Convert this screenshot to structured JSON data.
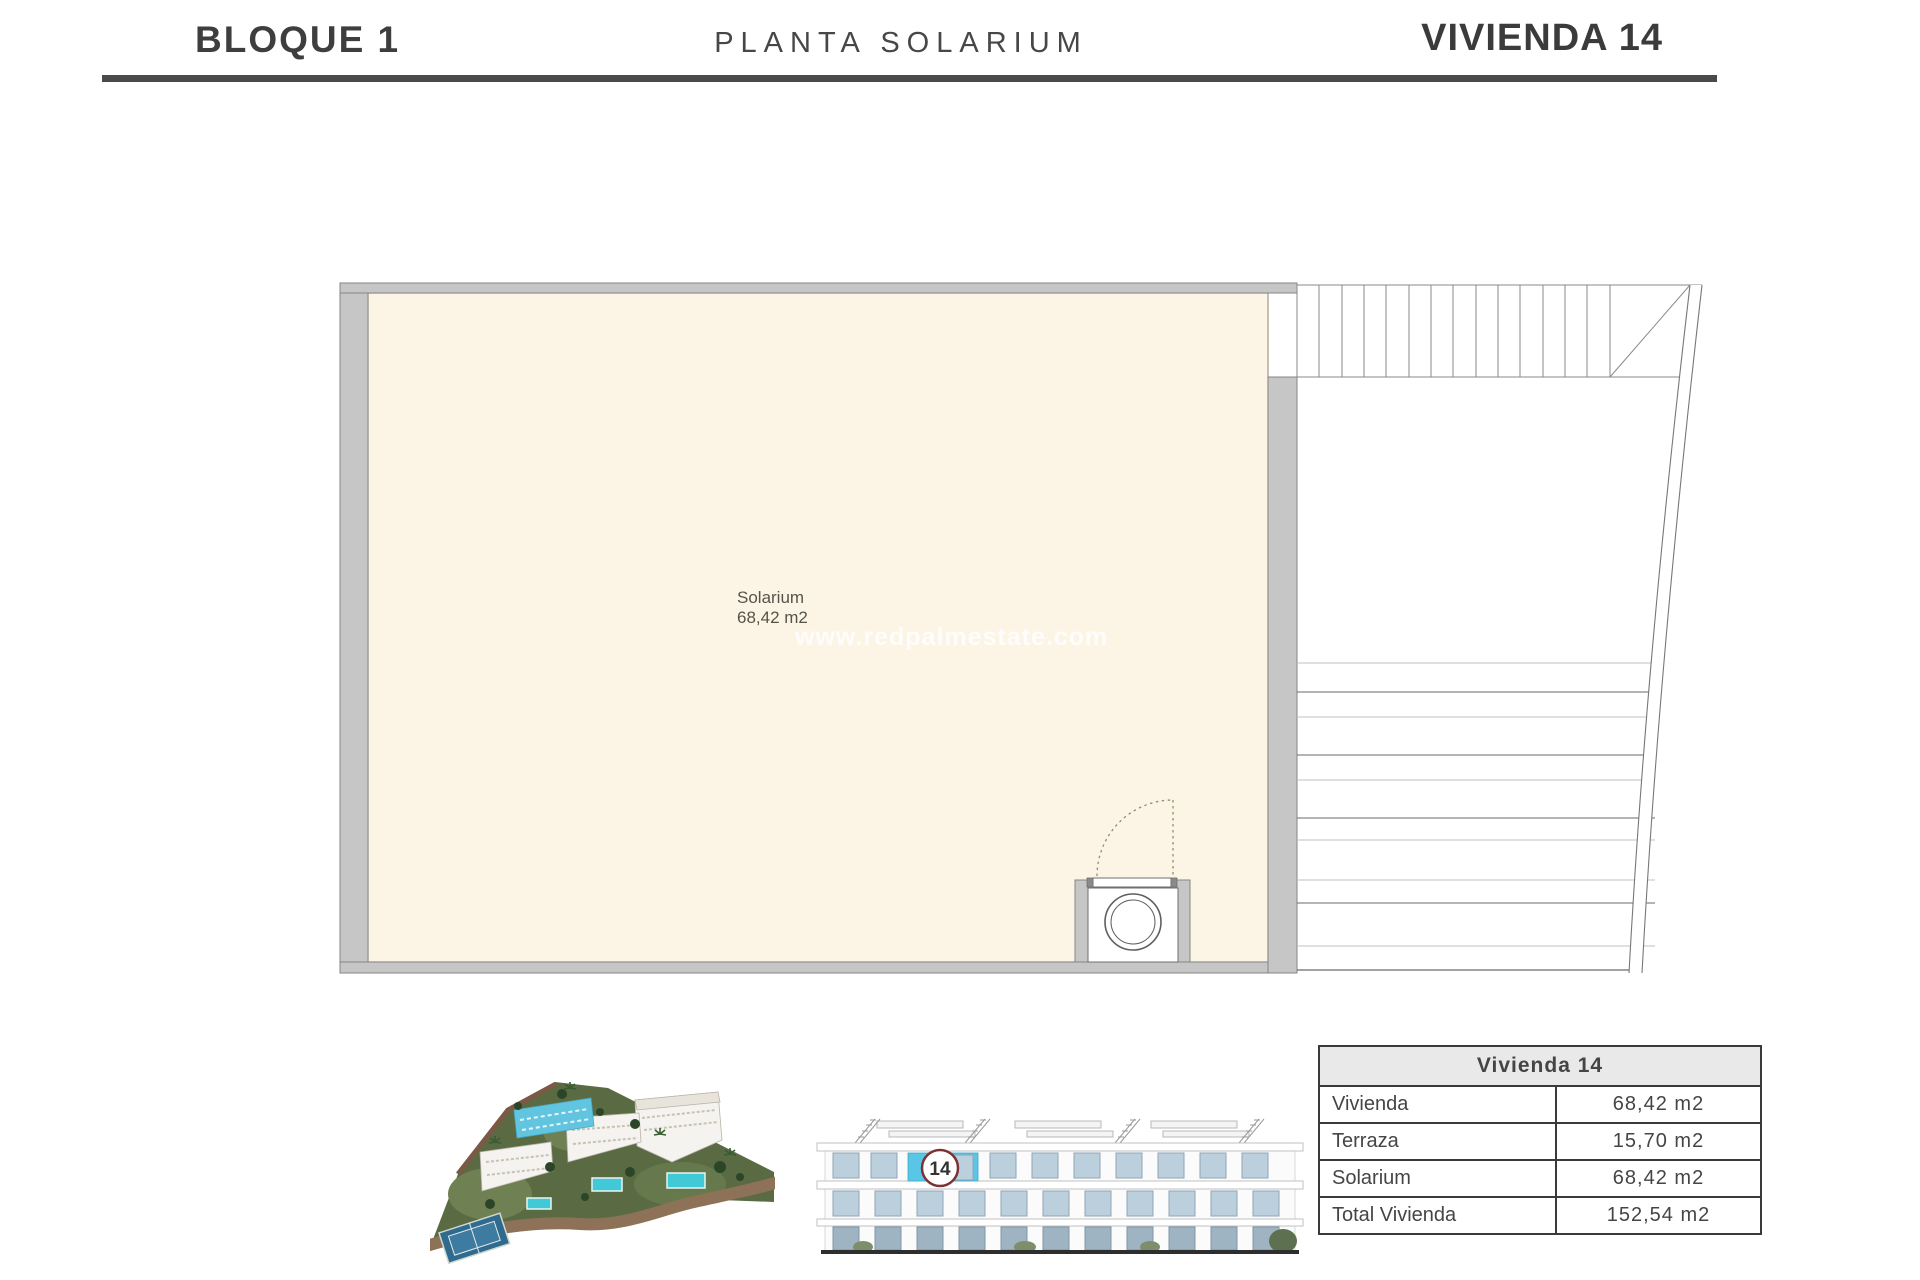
{
  "header": {
    "block_label": "BLOQUE 1",
    "floor_label": "PLANTA SOLARIUM",
    "unit_label": "VIVIENDA 14"
  },
  "plan": {
    "room_name": "Solarium",
    "room_area": "68,42 m2",
    "watermark": "www.redpalmestate.com"
  },
  "unit_table": {
    "title": "Vivienda 14",
    "rows": [
      {
        "label": "Vivienda",
        "value": "68,42 m2"
      },
      {
        "label": "Terraza",
        "value": "15,70 m2"
      },
      {
        "label": "Solarium",
        "value": "68,42 m2"
      },
      {
        "label": "Total Vivienda",
        "value": "152,54 m2"
      }
    ]
  },
  "elevation": {
    "badge": "14"
  },
  "colors": {
    "floor_fill": "#fcf5e5",
    "wall_fill": "#c6c6c6",
    "accent_cyan": "#5ac6e6",
    "badge_ring": "#7b3333",
    "header_rule": "#4a4a4a",
    "pool_teal": "#41c9d8"
  }
}
